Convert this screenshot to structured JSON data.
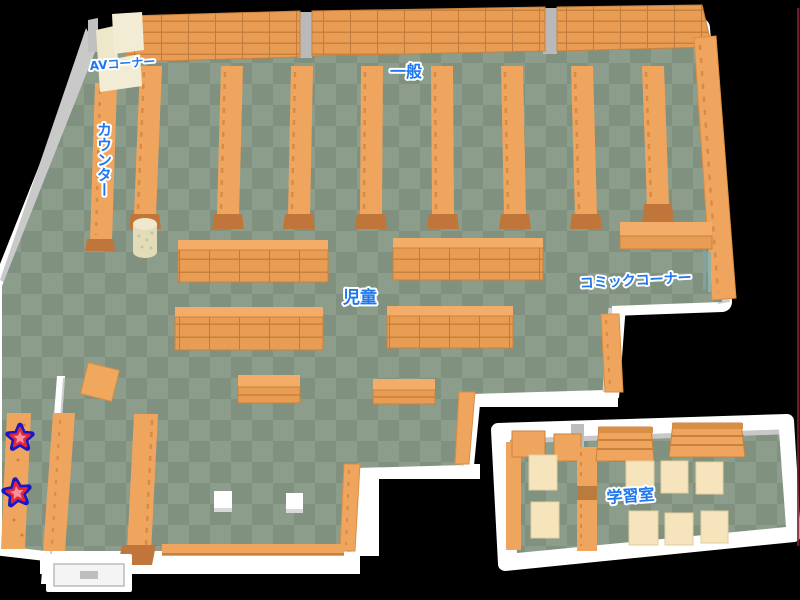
{
  "page": {
    "type": "library-floor-map",
    "background": "#000000"
  },
  "labels": {
    "av_corner": "AVコーナー",
    "counter": "カウンター",
    "general": "一般",
    "children": "児童",
    "comic_corner": "コミックコーナー",
    "study_room": "学習室"
  },
  "markers": {
    "star_count": 2,
    "star_fill": "#fb8e9e",
    "star_mid_outline": "#e02838",
    "star_outer_outline": "#1717c9"
  },
  "colors": {
    "floor_light": "#8d9d8b",
    "floor_dark": "#80917f",
    "shelf_orange": "#f0a55f",
    "shelf_front": "#e89c54",
    "shelf_line": "#c9823d",
    "shelf_base": "#c0763a",
    "wall_white": "#ffffff",
    "wall_gray": "#c9c9c9",
    "pillar_gray": "#b9b9b9",
    "desk_cream": "#f2ecd4",
    "table_cream": "#f6e5bc",
    "label_blue": "#1e77f0",
    "edge_line_red": "#7e1f2e"
  }
}
